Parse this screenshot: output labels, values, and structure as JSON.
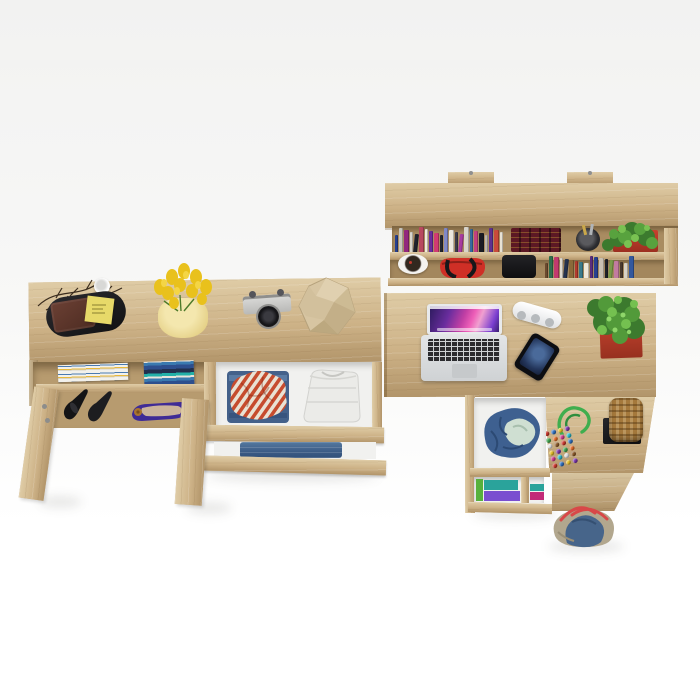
{
  "scene": {
    "description": "Top-down 3D product render of a light sonoma-oak home office furniture set (wall shelf, sideboard with open drawers and doors, corner desk with drawer pedestal) styled with accessories, on a plain white background",
    "canvas": {
      "width": 700,
      "height": 700
    },
    "pieces": [
      {
        "id": "wall-shelf",
        "label": "Wall-mounted double shelf with books and decor"
      },
      {
        "id": "sideboard",
        "label": "Long sideboard with open doors, shoes and pulled-out clothes drawers"
      },
      {
        "id": "corner-desk",
        "label": "Corner desk with laptop and drawer pedestal"
      }
    ]
  },
  "colors": {
    "bg-top": "#f2f2f1",
    "bg-bottom": "#ffffff",
    "oak": "#cdb287",
    "oak-light": "#dfcca6",
    "oak-dark": "#b2956a",
    "interior": "#f1f1ef",
    "accent-red": "#c03a2c",
    "plant-green": "#4f9638",
    "denim": "#44618a",
    "basket": "#a5793c",
    "strap-red": "#d84848",
    "rope-green": "#3fae4e",
    "tulip-yellow": "#e9c11c"
  },
  "wall_shelf": {
    "objects": [
      "row of paperback books",
      "dark-red encyclopedia set",
      "pen cup",
      "plant in red planter",
      "white bowl with potpourri",
      "red handbag",
      "black camera bag",
      "second row of books"
    ],
    "books_row1_spines": [
      "#27408f",
      "#c9c6bd",
      "#93277d",
      "#d8d5cc",
      "#20222c",
      "#b8485f",
      "#efe9dc",
      "#6a2d9e",
      "#d23a72",
      "#23252e",
      "#8088c6",
      "#ece8de",
      "#3c3c4a",
      "#a83aa0",
      "#d8d4cb",
      "#356aa0",
      "#c2407f",
      "#1b1c24",
      "#b9b5ae",
      "#5e3190",
      "#c94a3a",
      "#e8e2d4"
    ],
    "books_row2_spines": [
      "#6b4a2e",
      "#2f6e4e",
      "#c23a6e",
      "#ded9cf",
      "#24324e",
      "#8a6a3a",
      "#b23a2e",
      "#3a7a8a",
      "#efe8da",
      "#5a2d7e",
      "#27408f",
      "#c9c0b2",
      "#1e2028",
      "#7a9a4a",
      "#c27ba0",
      "#4a3a2e",
      "#d8d2c6",
      "#33589e"
    ]
  },
  "sideboard": {
    "objects": [
      "decorative twigs",
      "white mug",
      "black oval tray",
      "brown leather wallet",
      "yellow sticky note",
      "yellow tulips in pale vase",
      "vintage film camera",
      "beige faceted deco polyhedron",
      "stack of magazines",
      "stack of blue books",
      "black stiletto heels",
      "purple ballet flats",
      "open drawer with striped shirt and white laundry",
      "second drawer with folded jeans",
      "two open doors"
    ]
  },
  "desk": {
    "objects": [
      "open silver laptop with purple aurora wallpaper",
      "white power strip",
      "smartphone",
      "succulent in square red pot",
      "wicker basket on black stand",
      "beaded toy on green cord",
      "open pedestal drawer with blue clothes",
      "pedestal shelf with folded colorful clothes",
      "denim-and-canvas holdall bag"
    ],
    "toy_bead_colors": [
      "#c8372d",
      "#2f6fbe",
      "#e3bd2a",
      "#7b35a8",
      "#3fa14c",
      "#df6b28",
      "#cc3a8c",
      "#28b7c8",
      "#e0e0e0",
      "#8a5a2a"
    ],
    "clothes_stack_colors": [
      "#2aa39b",
      "#7a4fd0",
      "#57b13c",
      "#c22a78"
    ]
  }
}
